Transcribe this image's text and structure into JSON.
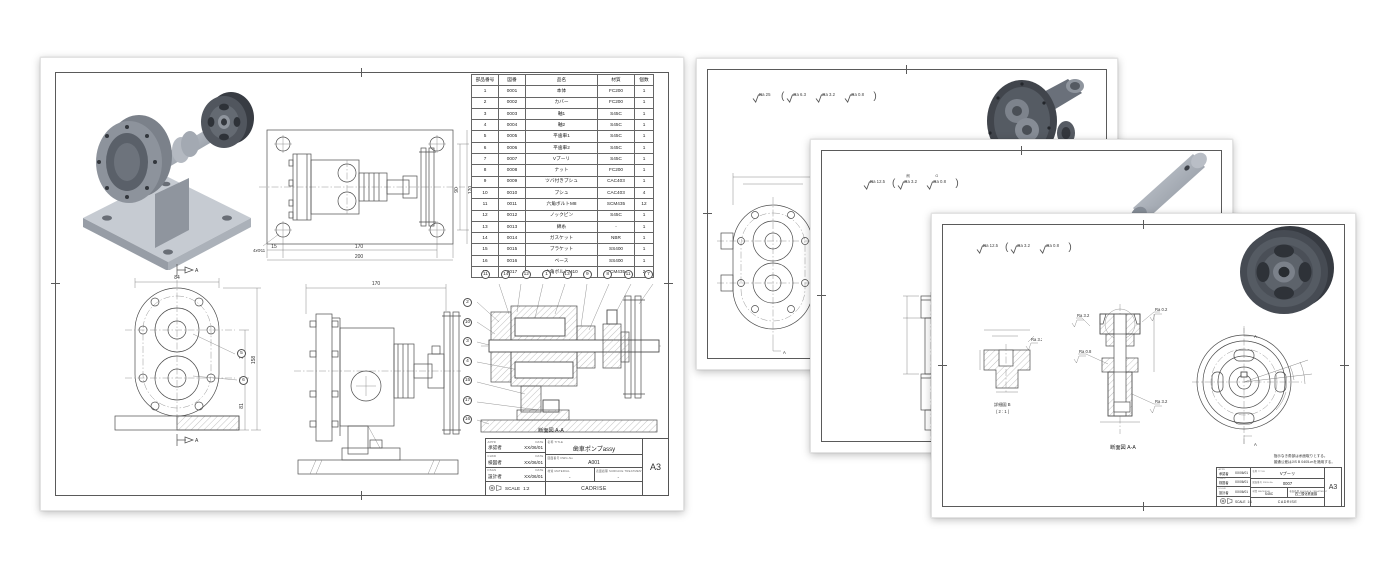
{
  "left_sheet": {
    "sheet_size": "A3",
    "parts_table": {
      "headers": [
        "部品番号",
        "図番",
        "品名",
        "材質",
        "個数"
      ],
      "rows": [
        [
          "1",
          "0001",
          "本体",
          "FC200",
          "1"
        ],
        [
          "2",
          "0002",
          "カバー",
          "FC200",
          "1"
        ],
        [
          "3",
          "0003",
          "軸1",
          "S45C",
          "1"
        ],
        [
          "4",
          "0004",
          "軸2",
          "S45C",
          "1"
        ],
        [
          "5",
          "0005",
          "平歯車1",
          "S45C",
          "1"
        ],
        [
          "6",
          "0006",
          "平歯車2",
          "S45C",
          "1"
        ],
        [
          "7",
          "0007",
          "Vプーリ",
          "S45C",
          "1"
        ],
        [
          "8",
          "0008",
          "ナット",
          "FC200",
          "1"
        ],
        [
          "9",
          "0009",
          "ツバ付きブシュ",
          "CAC403",
          "1"
        ],
        [
          "10",
          "0010",
          "ブシュ",
          "CAC403",
          "4"
        ],
        [
          "11",
          "0011",
          "六角ボルトM8",
          "SCM435",
          "12"
        ],
        [
          "12",
          "0012",
          "ノックピン",
          "S45C",
          "1"
        ],
        [
          "13",
          "0013",
          "綿糸",
          "-",
          "1"
        ],
        [
          "14",
          "0014",
          "ガスケット",
          "NBR",
          "1"
        ],
        [
          "15",
          "0015",
          "ブラケット",
          "SS400",
          "1"
        ],
        [
          "16",
          "0016",
          "ベース",
          "SS400",
          "1"
        ],
        [
          "17",
          "0017",
          "六角ボルトM10",
          "SCM435",
          "2"
        ]
      ]
    },
    "top_view": {
      "dim_15": "15",
      "dim_170": "170",
      "dim_200": "200",
      "dim_90": "90",
      "dim_120": "120",
      "hole_note": "4xΦ11"
    },
    "front_view": {
      "dim_84": "84",
      "dim_158": "158",
      "dim_35": "35",
      "dim_81": "81",
      "section_letter": "A",
      "balloons": [
        "5",
        "6"
      ]
    },
    "side_view": {
      "dim_170": "170"
    },
    "section_view": {
      "caption": "断面図 A-A",
      "balloons_top": [
        "11",
        "14",
        "12",
        "1",
        "13",
        "9",
        "8",
        "11",
        "7"
      ],
      "balloons_left": [
        "2",
        "10",
        "3",
        "4",
        "15",
        "17",
        "16"
      ]
    },
    "title_block": {
      "rows": [
        {
          "role_label": "APPD",
          "date_label": "DATE",
          "name": "承認者",
          "date": "XX/06/01"
        },
        {
          "role_label": "CHKD",
          "date_label": "DATE",
          "name": "検図者",
          "date": "XX/06/01"
        },
        {
          "role_label": "DSGN",
          "date_label": "DATE",
          "name": "設計者",
          "date": "XX/06/01"
        }
      ],
      "title_label": "名称 TITLE",
      "title": "歯車ポンプassy",
      "dwg_label": "図面番号 DWG-No",
      "dwg_no": "A001",
      "material_label": "材質 MATERIAL",
      "material": "-",
      "surface_label": "表面処理 SURFACE TREATMENT",
      "surface": "-",
      "scale_label": "SCALE",
      "scale": "1:2",
      "org": "CADRISE",
      "size": "A3"
    }
  },
  "back_sheet": {
    "roughness_main": "Ra 25",
    "roughness_inner": [
      "Ra 6.3",
      "Ra 3.2",
      "Ra 0.8"
    ],
    "callout": "Ra 6.3"
  },
  "mid_sheet": {
    "roughness_main": "Ra 12.5",
    "rough1_note": "削",
    "rough1": "Ra 3.2",
    "rough2_note": "G",
    "rough2": "Ra 0.8"
  },
  "front_sheet": {
    "roughness_main": "Ra 12.5",
    "roughness_inner": [
      "Ra 3.2",
      "Ra 0.8"
    ],
    "detail_callout": "Ra 3.2",
    "detail_caption": "詳細図 B",
    "detail_scale": "( 2 : 1 )",
    "section_caption": "断面図 A-A",
    "callout_ra32": "Ra 3.2",
    "callout_ra02": "Ra 0.2",
    "callout_ra08": "Ra 0.8",
    "section_letter": "A",
    "note_line1": "指示なき角部は糸面取りとする。",
    "note_line2": "普通公差はJIS B 0405-mを適用する。",
    "title_block": {
      "rows": [
        {
          "role_label": "APPD",
          "date_label": "DATE",
          "name": "承認者",
          "date": "XX/06/01"
        },
        {
          "role_label": "CHKD",
          "date_label": "DATE",
          "name": "検図者",
          "date": "XX/06/01"
        },
        {
          "role_label": "DSGN",
          "date_label": "DATE",
          "name": "設計者",
          "date": "XX/06/01"
        }
      ],
      "title_label": "名称 TITLE",
      "title": "Vプーリ",
      "dwg_label": "図面番号 DWG-No",
      "dwg_no": "0007",
      "material_label": "材質 MATERIAL",
      "material": "S45C",
      "surface_label": "表面処理 SURFACE TREATMENT",
      "surface": "四三酸化鉄被膜",
      "scale_label": "SCALE",
      "scale": "1:1",
      "org": "CADRISE",
      "size": "A3"
    }
  }
}
